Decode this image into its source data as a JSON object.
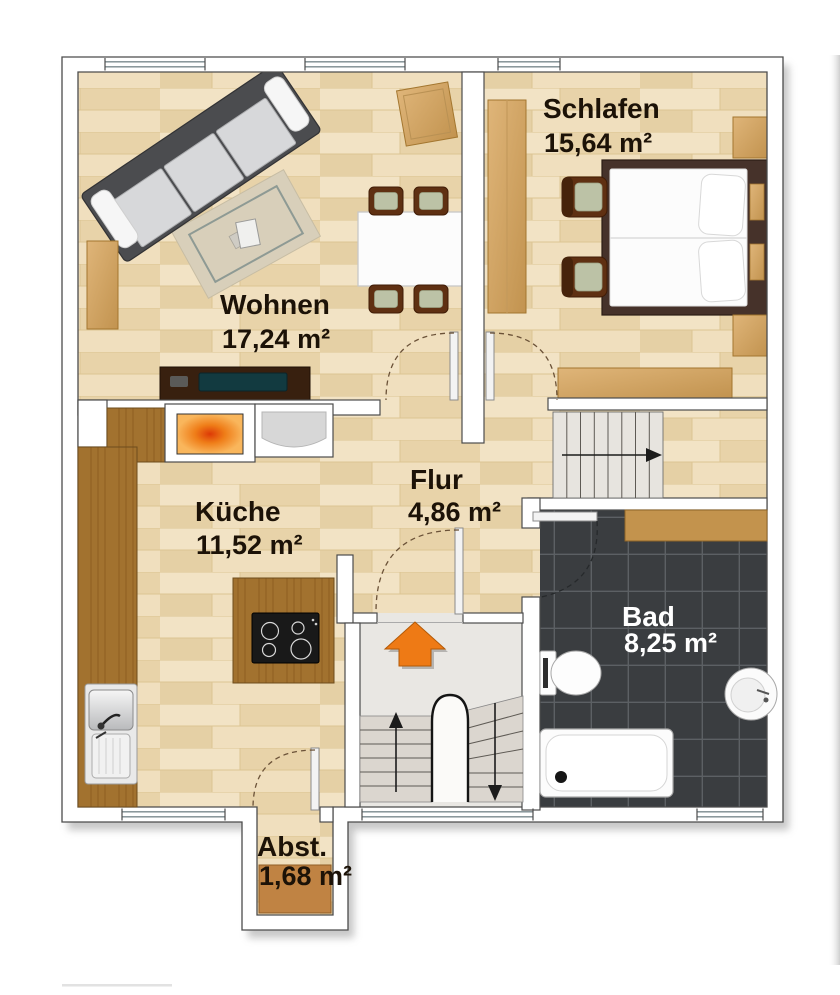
{
  "floorplan": {
    "rooms": [
      {
        "id": "wohnen",
        "label": "Wohnen",
        "area": "17,24 m²",
        "floor": "wood"
      },
      {
        "id": "schlafen",
        "label": "Schlafen",
        "area": "15,64 m²",
        "floor": "wood"
      },
      {
        "id": "kueche",
        "label": "Küche",
        "area": "11,52 m²",
        "floor": "wood"
      },
      {
        "id": "flur",
        "label": "Flur",
        "area": "4,86 m²",
        "floor": "wood"
      },
      {
        "id": "bad",
        "label": "Bad",
        "area": "8,25 m²",
        "floor": "dark-tile"
      },
      {
        "id": "abstellraum",
        "label": "Abst.",
        "area": "1,68 m²",
        "floor": "wood"
      }
    ],
    "furniture": {
      "wohnen": [
        "sofa",
        "rug",
        "sideboard",
        "tv-lowboard",
        "dining-table",
        "dining-chairs",
        "side-table"
      ],
      "schlafen": [
        "wardrobe",
        "double-bed",
        "pillows",
        "nightstands",
        "armchairs",
        "dresser"
      ],
      "kueche": [
        "counter",
        "fireplace-stove",
        "appliance",
        "cooking-island",
        "cooktop",
        "sink"
      ],
      "bad": [
        "shelf",
        "toilet",
        "washbasin",
        "bathtub"
      ]
    },
    "stairs": [
      {
        "id": "upper-staircase",
        "arrow": "right"
      },
      {
        "id": "entry-stairs-up",
        "arrow": "up"
      },
      {
        "id": "entry-stairs-down",
        "arrow": "down"
      }
    ],
    "entrance_arrow": {
      "direction": "up",
      "color": "#ee7a15"
    },
    "colors": {
      "wall": "#ffffff",
      "wall_outline": "#4c4c4c",
      "floor_wood": "#ecd9b3",
      "tile_dark": "#3a3d40",
      "wood_counter": "#a2722f",
      "wood_furniture": "#d2a566",
      "bed_frame": "#46322a",
      "accent_orange": "#ee7a15",
      "landing_floor": "#e9e7e3"
    }
  }
}
